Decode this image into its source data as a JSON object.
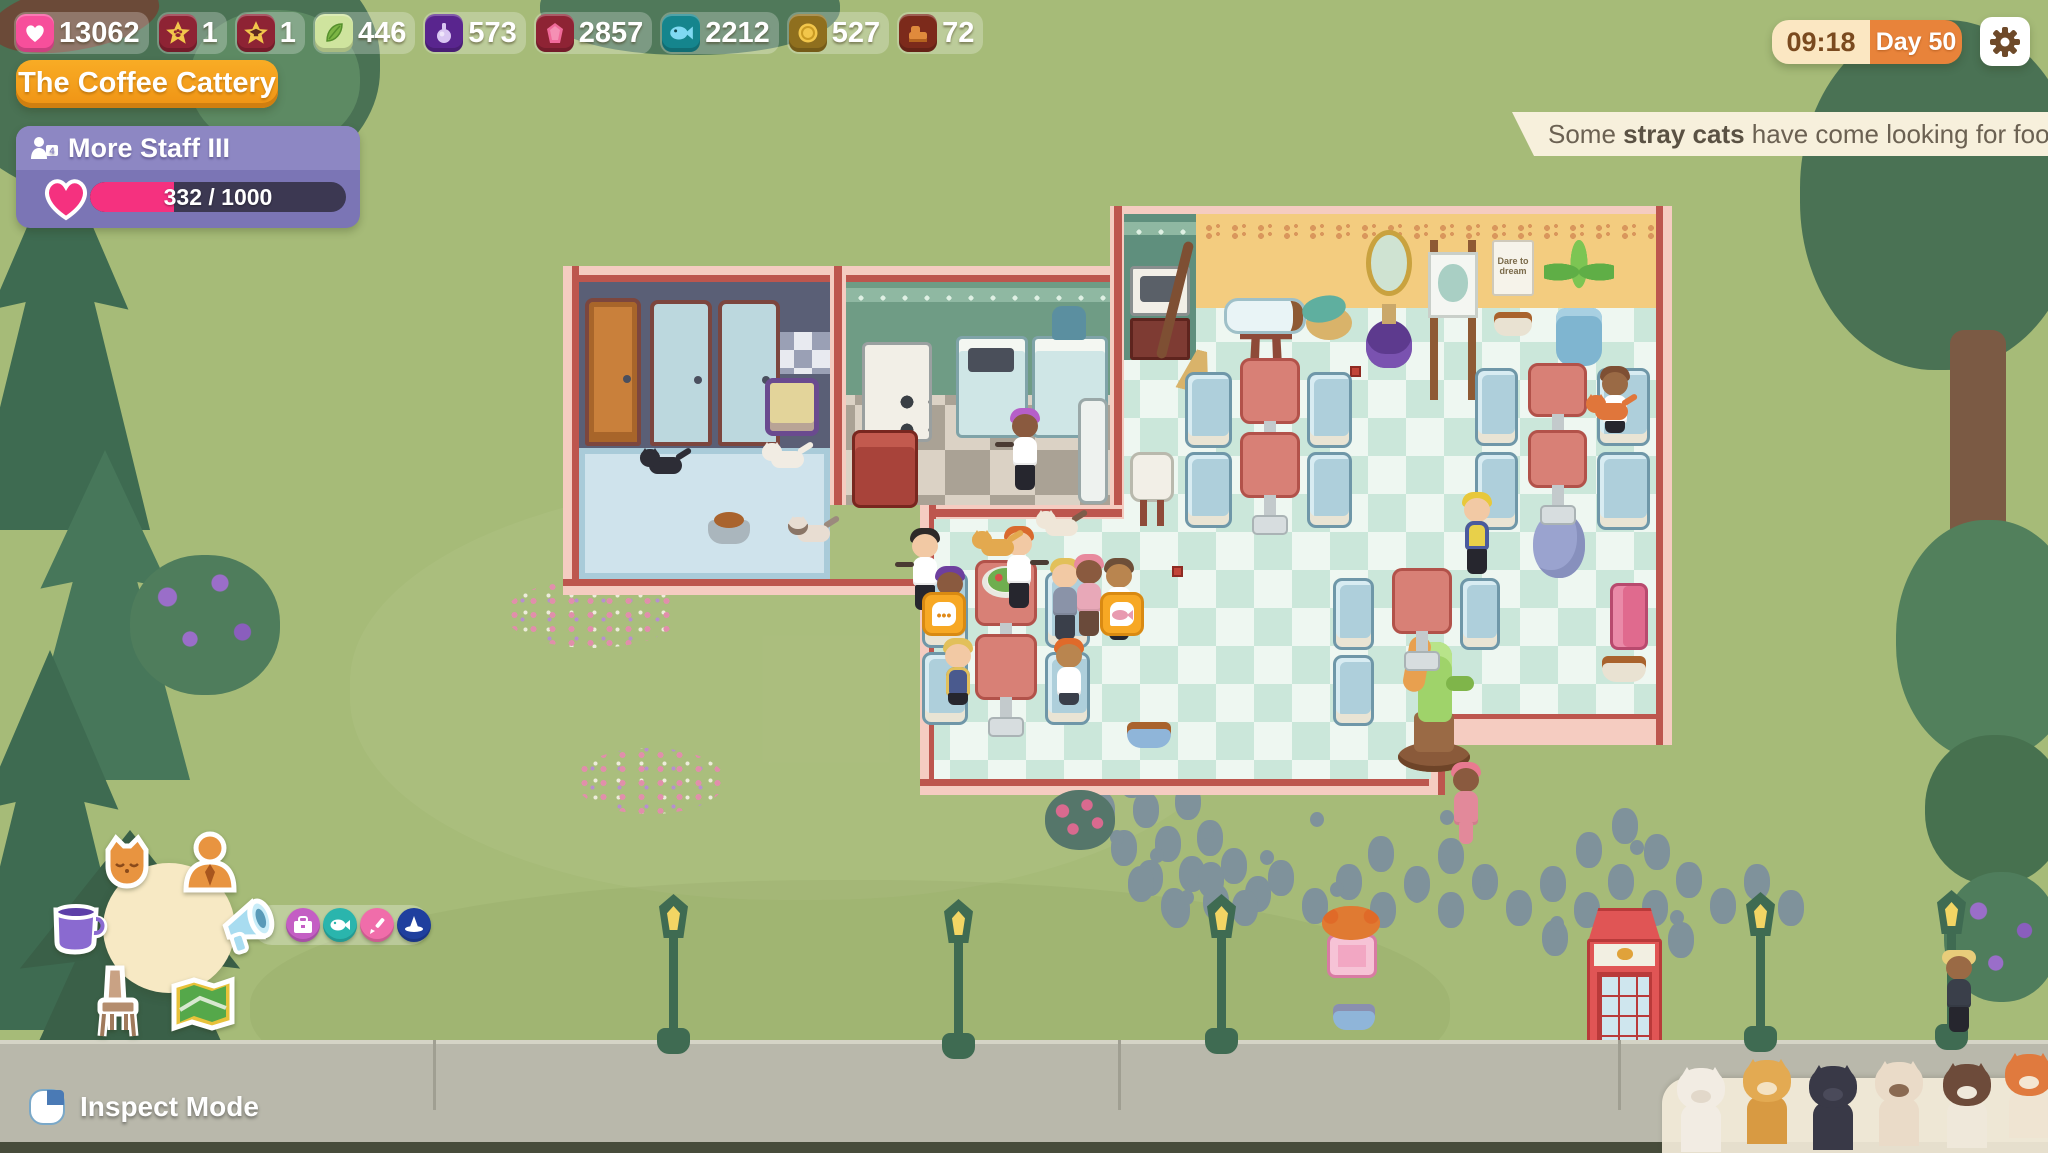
{
  "hud": {
    "resources": [
      {
        "name": "hearts",
        "value": "13062",
        "tile_color": "#f74f9b"
      },
      {
        "name": "skill-star-paw",
        "value": "1",
        "tile_color": "#8e2334"
      },
      {
        "name": "skill-star-cap",
        "value": "1",
        "tile_color": "#8e2334"
      },
      {
        "name": "catnip",
        "value": "446",
        "tile_color": "#cfe49e"
      },
      {
        "name": "potion",
        "value": "573",
        "tile_color": "#59258e"
      },
      {
        "name": "gem",
        "value": "2857",
        "tile_color": "#8e2334"
      },
      {
        "name": "fish",
        "value": "2212",
        "tile_color": "#15858d"
      },
      {
        "name": "coins",
        "value": "527",
        "tile_color": "#8f6f1e"
      },
      {
        "name": "furniture",
        "value": "72",
        "tile_color": "#7c2a1b"
      }
    ],
    "cafe_name": "The Coffee Cattery",
    "goal": {
      "title": "More Staff III",
      "badge": "4",
      "current": 332,
      "max": 1000,
      "progress_text": "332 / 1000"
    },
    "clock": {
      "time": "09:18",
      "day": "Day 50"
    },
    "notification": {
      "prefix": "Some ",
      "bold": "stray cats",
      "suffix": " have come looking for food!"
    },
    "inspect_label": "Inspect Mode",
    "menu_icons": [
      "cat-menu",
      "staff-menu",
      "drinks-menu",
      "marketing-menu",
      "furniture-menu",
      "map-menu"
    ],
    "menu_sub_icons": [
      "briefcase",
      "fishing",
      "painting",
      "witchcraft"
    ]
  },
  "world": {
    "poster_text": "Dare to dream",
    "stray_cats": [
      "white-cat",
      "ginger-cat",
      "black-cat",
      "siamese-cat",
      "brown-white-cat",
      "orange-tabby-cat"
    ]
  },
  "colors": {
    "brand_orange": "#f59c1d",
    "goal_purple": "#7b75b5",
    "progress_pink": "#f5317f",
    "notification_cream": "#f7f0dc",
    "day_orange": "#e8833a",
    "time_cream": "#fbe7c2",
    "wall_pink": "#f5ccc1",
    "wall_red": "#bd564e"
  }
}
